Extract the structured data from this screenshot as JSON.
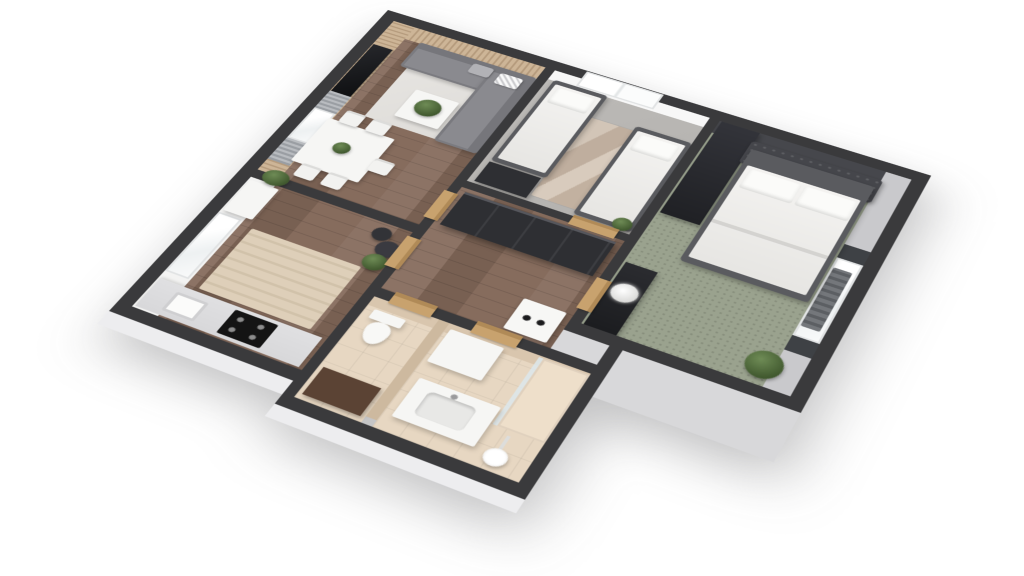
{
  "scene": {
    "kind": "3d-floorplan-render",
    "view": "axonometric tilted top-down",
    "background": "#ffffff",
    "visible_text": ""
  },
  "palette": {
    "wall": "#3a3a3c",
    "wall_face": "#f7f7f7",
    "exterior_face": "#d8d8da",
    "exterior_face_light": "#ededef",
    "wood": "#84695a",
    "wood_dark": "#6d564a",
    "slat": "#cdb597",
    "slat_dark": "#b59b7d",
    "kids_floor": "#b4b2af",
    "carpet": "#9aa28e",
    "tile": "#e7d7c2",
    "tile_wall": "#cdb99f",
    "sofa": "#8a8a8f",
    "sofa_dark": "#76767b",
    "bed_frame": "#5a5b5f",
    "headboard": "#45464b",
    "dark_furniture": "#2e2f33",
    "door_wood": "#c8a26e",
    "counter": "#d8d8da",
    "cooktop": "#141414",
    "curtain": "#9a9ea3",
    "curtain_dark": "#3e4145",
    "plant_green": "#6f8c56",
    "plant_dark": "#41592f",
    "glass": "#dce7ec",
    "white_furniture": "#f6f6f4"
  },
  "rooms": [
    {
      "name": "Living room",
      "floor": "wood planks",
      "features": [
        "wood slat accent walls",
        "wall mounted tv",
        "gray curtains",
        "window"
      ],
      "furniture": [
        "corner sofa",
        "throw pillows",
        "coffee table with plant",
        "light area rug",
        "dining table",
        "white chairs",
        "plants"
      ]
    },
    {
      "name": "Children's bedroom",
      "floor": "light gray",
      "features": [
        "window on top wall"
      ],
      "furniture": [
        "single bed",
        "single bed",
        "marble rug",
        "dark dresser",
        "plant"
      ]
    },
    {
      "name": "Master bedroom",
      "floor": "sage green carpet",
      "features": [
        "window with dark curtains",
        "radiator"
      ],
      "furniture": [
        "double bed with tufted headboard",
        "tall dark wardrobe",
        "dark cabinet with white flowers",
        "plant"
      ]
    },
    {
      "name": "Hallway",
      "floor": "wood planks",
      "features": [
        "wood doors"
      ],
      "furniture": [
        "large dark wardrobe",
        "washing machine"
      ]
    },
    {
      "name": "Kitchen",
      "floor": "wood planks",
      "features": [
        "window",
        "white wall cabinets"
      ],
      "furniture": [
        "fridge",
        "counter with sink",
        "black cooktop",
        "striped rug",
        "dark vases with plant"
      ]
    },
    {
      "name": "WC",
      "floor": "beige tile",
      "furniture": [
        "toilet",
        "brown cabinet"
      ],
      "features": []
    },
    {
      "name": "Bathroom",
      "floor": "beige tile",
      "features": [
        "glass shower partition"
      ],
      "furniture": [
        "vanity with sink",
        "white cabinet",
        "shower head",
        "shower tray"
      ]
    }
  ]
}
